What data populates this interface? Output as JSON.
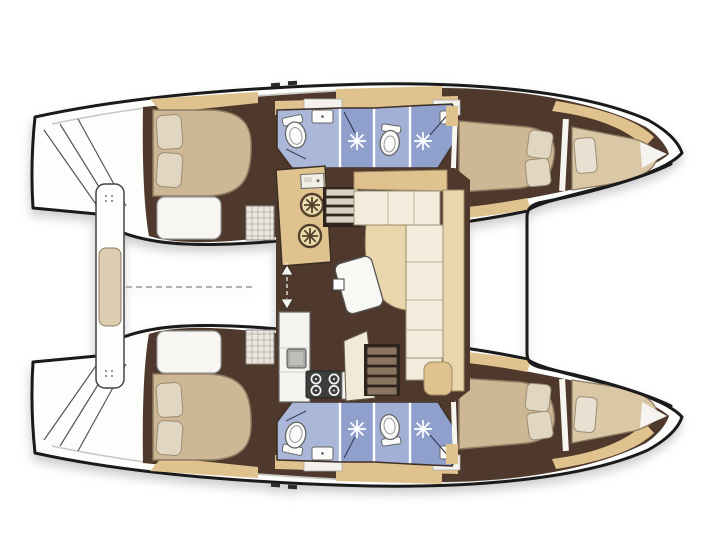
{
  "meta": {
    "description": "Top-view interior layout plan of a sailing catamaran, bows to the right: 4 cabins, 4 heads, central salon with galley, dinette sofa, companionway stairs, aft cockpit bench and forward trampoline beam",
    "orientation": "bows-right"
  },
  "colors": {
    "page_bg": "#ffffff",
    "outline": "#1a1a1a",
    "deck": "#fdfdfc",
    "floor": "#4e392c",
    "wood": "#dfc28e",
    "wood_light": "#e9d6ac",
    "mattress": "#cdb794",
    "pillow": "#e0d6c2",
    "cushion": "#f1ecdc",
    "berth": "#f7f6f2",
    "bath_floor": "#aab7d9",
    "bath_mid": "#a3b0d5",
    "bath_shower": "#8fa0cd",
    "fixture": "#fbfbf9",
    "appliance": "#a8a8a5",
    "stove": "#3d3d3b",
    "burner_plate": "#ecdcae",
    "burner_ring": "#54422e",
    "table": "#f8f8f5",
    "trim_line": "#c6c6c2",
    "dashed_line": "#9a9a98",
    "step_light": "#d8d2c2",
    "step_dark": "#8a7560",
    "stair_well": "#2e241c",
    "bench_cushion": "#ddcdb0",
    "hatch_grid": "#eee8dc",
    "shower_star": "#ffffff",
    "hose": "#3a3f55",
    "door_line": "#ffffff"
  },
  "icons": {
    "toilet": "toilet-oval-with-cistern",
    "shower": "shower-head-starburst",
    "sink": "basin-rect-with-drain-dot",
    "burner": "round-burner-with-trivet-cross",
    "stove": "four-burner-cooktop",
    "companionway_door": "dashed-line-with-up-down-arrows",
    "steps": "ladder-treads",
    "cleat": "deck-cleat-dash"
  }
}
